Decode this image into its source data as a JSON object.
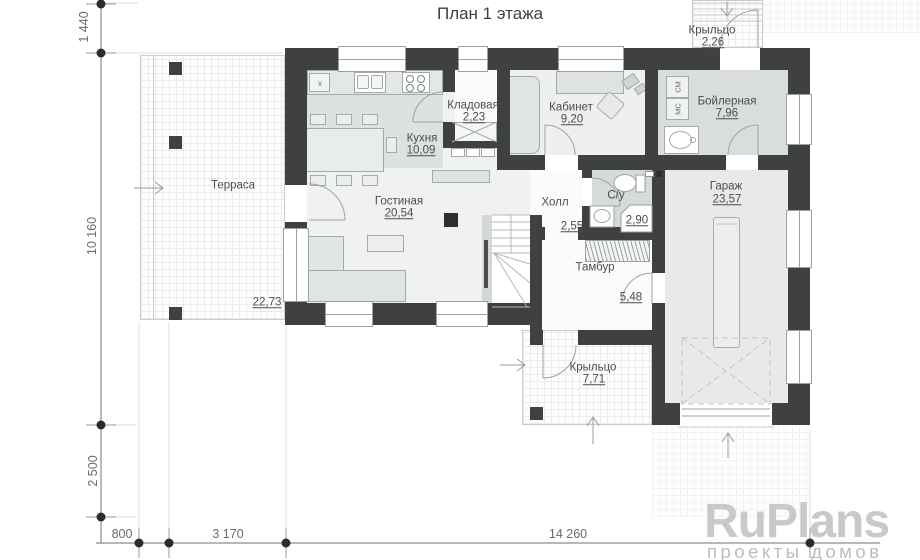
{
  "title": "План 1 этажа",
  "rooms": [
    {
      "name": "Терраса",
      "area": "22,73"
    },
    {
      "name": "Кухня",
      "area": "10,09"
    },
    {
      "name": "Кладовая",
      "area": "2,23"
    },
    {
      "name": "Кабинет",
      "area": "9,20"
    },
    {
      "name": "Бойлерная",
      "area": "7,96"
    },
    {
      "name": "Гостиная",
      "area": "20,54"
    },
    {
      "name": "Холл",
      "area": "2,55"
    },
    {
      "name": "С/у",
      "area": "2,90"
    },
    {
      "name": "Тамбур",
      "area": "5,48"
    },
    {
      "name": "Гараж",
      "area": "23,57"
    },
    {
      "name": "Крыльцо",
      "area": "7,71"
    },
    {
      "name": "Крыльцо",
      "area": "2,26"
    }
  ],
  "dimensions": {
    "left": [
      "1 440",
      "10 160",
      "2 500"
    ],
    "bottom": [
      "800",
      "3 170",
      "14 260"
    ]
  },
  "kitchen": {
    "hood_label": "x"
  },
  "boiler_appliances": [
    "СМ",
    "МС"
  ],
  "watermark": {
    "brand": "RuPlans",
    "tagline": "проекты домов"
  },
  "colors": {
    "wall": "#3e4041",
    "floor_gray": "#dde1e2",
    "floor_light": "#f0f1f1",
    "watermark": "#c9c9c9"
  }
}
